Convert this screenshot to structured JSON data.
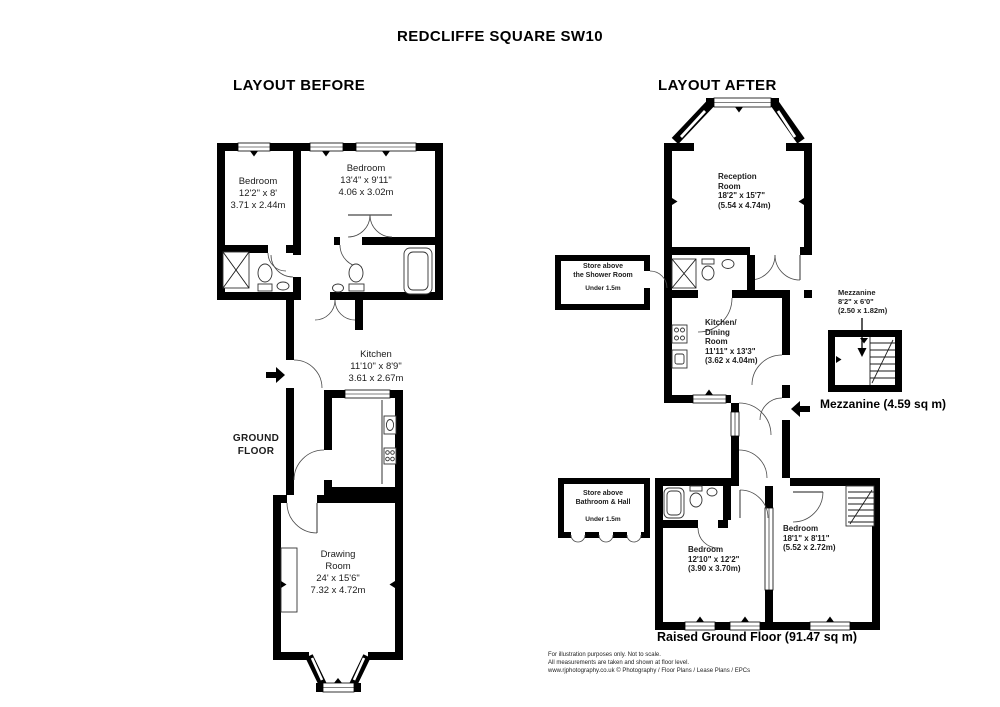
{
  "page": {
    "title": "REDCLIFFE SQUARE SW10"
  },
  "before": {
    "heading": "LAYOUT BEFORE",
    "floor_label": "GROUND FLOOR",
    "rooms": {
      "bedroom_left": {
        "name": "Bedroom",
        "imperial": "12'2\" x 8'",
        "metric": "3.71 x 2.44m"
      },
      "bedroom_right": {
        "name": "Bedroom",
        "imperial": "13'4\" x 9'11\"",
        "metric": "4.06 x 3.02m"
      },
      "kitchen": {
        "name": "Kitchen",
        "imperial": "11'10\" x 8'9\"",
        "metric": "3.61 x 2.67m"
      },
      "drawing_room": {
        "name": "Drawing Room",
        "imperial": "24' x 15'6\"",
        "metric": "7.32 x 4.72m"
      }
    }
  },
  "after": {
    "heading": "LAYOUT AFTER",
    "rooms": {
      "reception": {
        "name": "Reception Room",
        "imperial": "18'2\" x 15'7\"",
        "metric": "(5.54 x 4.74m)"
      },
      "kitchen_dining": {
        "name": "Kitchen/ Dining Room",
        "imperial": "11'11\" x 13'3\"",
        "metric": "(3.62 x 4.04m)"
      },
      "bedroom_left": {
        "name": "Bedroom",
        "imperial": "12'10\" x 12'2\"",
        "metric": "(3.90 x 3.70m)"
      },
      "bedroom_right": {
        "name": "Bedroom",
        "imperial": "18'1\" x 8'11\"",
        "metric": "(5.52 x 2.72m)"
      },
      "mezzanine": {
        "name": "Mezzanine",
        "imperial": "8'2\" x 6'0\"",
        "metric": "(2.50 x 1.82m)"
      }
    },
    "store_shower": {
      "line1": "Store above",
      "line2": "the Shower Room",
      "under": "Under 1.5m"
    },
    "store_bathroom": {
      "line1": "Store above",
      "line2": "Bathroom & Hall",
      "under": "Under 1.5m"
    },
    "mezzanine_area": "Mezzanine (4.59 sq m)",
    "floor_label": "Raised Ground Floor (91.47 sq m)"
  },
  "footer": {
    "line1": "For illustration purposes only. Not to scale.",
    "line2": "All measurements are taken and shown at floor level.",
    "line3": "www.rjphotography.co.uk © Photography / Floor Plans / Lease Plans / EPCs"
  }
}
